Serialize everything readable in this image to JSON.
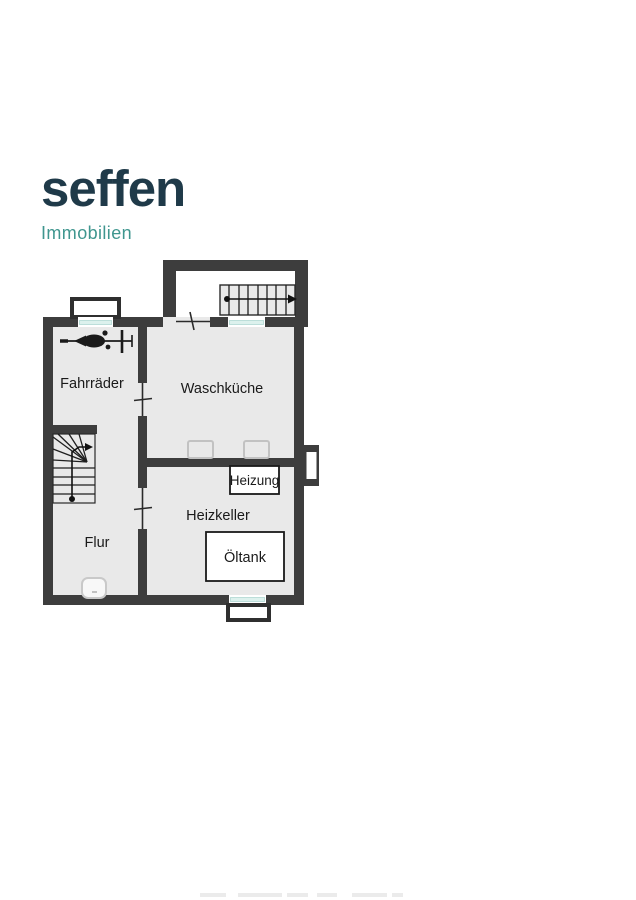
{
  "page": {
    "background": "#ffffff"
  },
  "logo": {
    "brand": "seffen",
    "tagline": "Immobilien",
    "brand_color": "#1f3a49",
    "tagline_color": "#3f968f"
  },
  "floorplan": {
    "colors": {
      "wall": "#3d3d3d",
      "floor": "#e9e9e9",
      "window_glass": "#dcf1ed",
      "equipment_outline": "#1a1a1a"
    },
    "rooms": {
      "fahrraeder": {
        "label": "Fahrräder"
      },
      "waschkueche": {
        "label": "Waschküche"
      },
      "heizkeller": {
        "label": "Heizkeller"
      },
      "flur": {
        "label": "Flur"
      }
    },
    "equipment": {
      "heizung": {
        "label": "Heizung"
      },
      "oeltank": {
        "label": "Öltank"
      }
    }
  }
}
